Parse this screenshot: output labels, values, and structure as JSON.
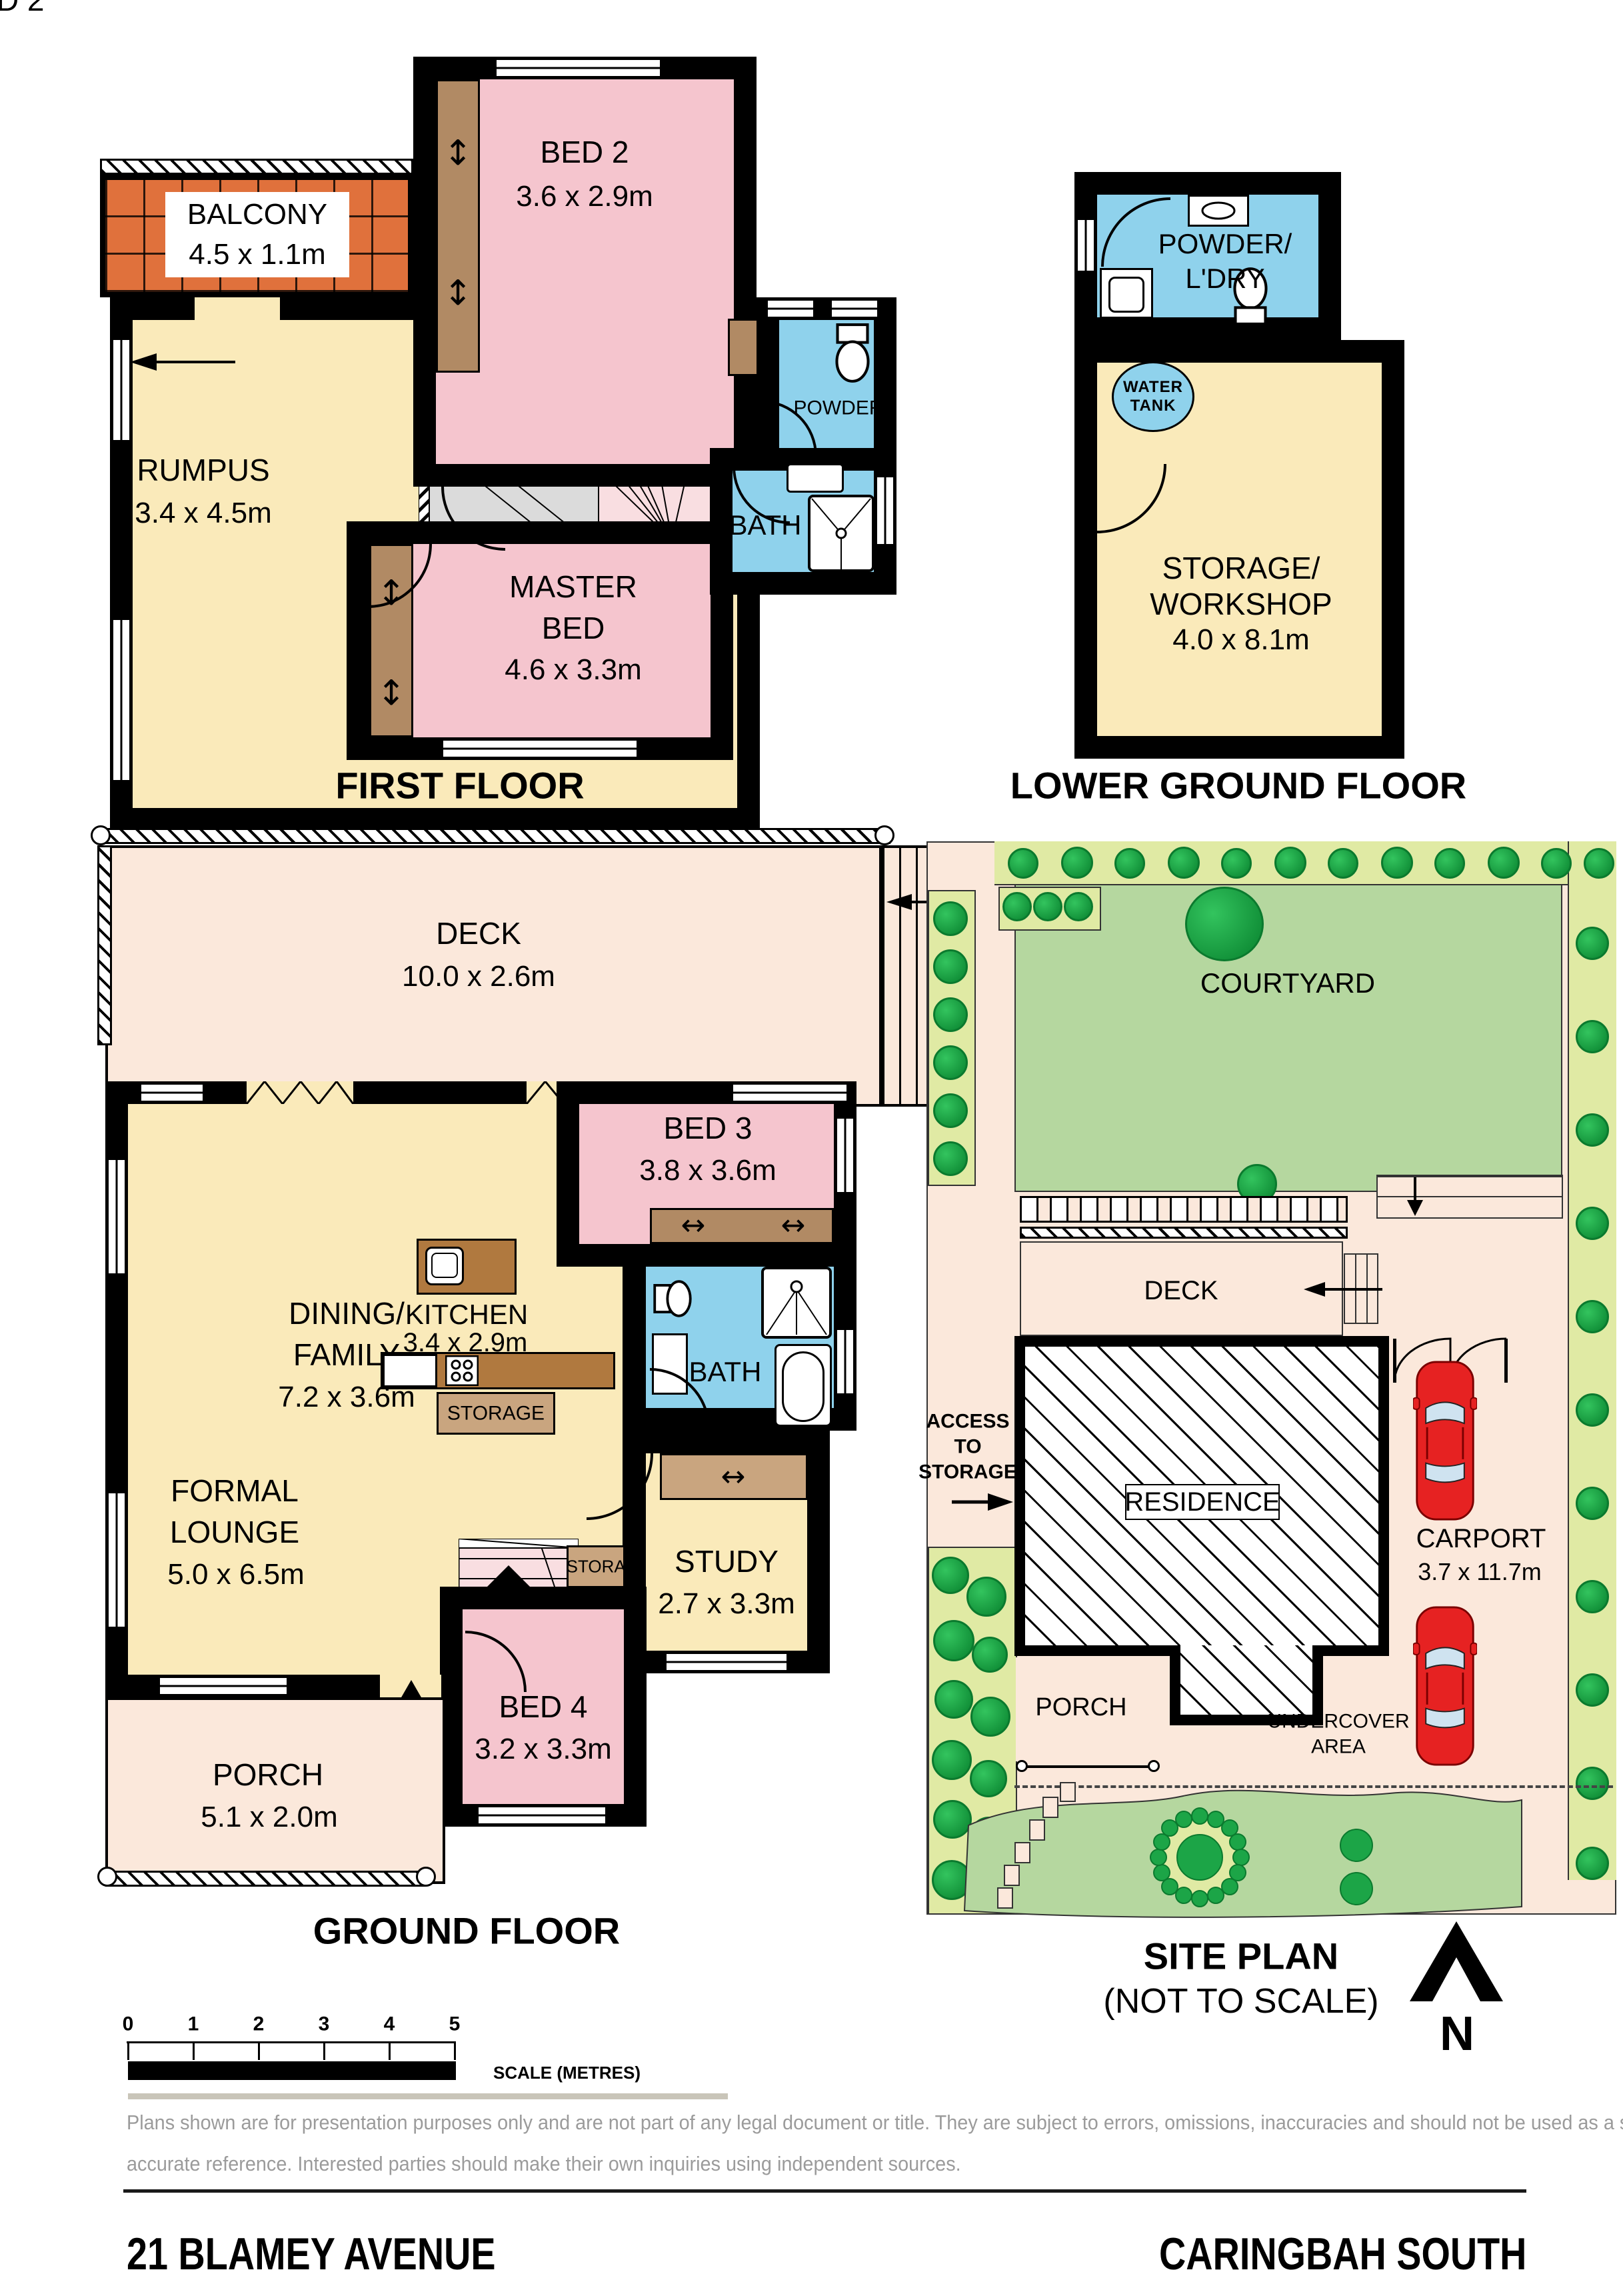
{
  "titles": {
    "first": "FIRST FLOOR",
    "lower": "LOWER GROUND FLOOR",
    "ground": "GROUND FLOOR",
    "site": "SITE PLAN",
    "site_note": "(NOT TO SCALE)"
  },
  "first_floor": {
    "bed2": {
      "name": "BED 2",
      "dims": "3.6 x 2.9m"
    },
    "balcony": {
      "name": "BALCONY",
      "dims": "4.5 x 1.1m"
    },
    "rumpus": {
      "name": "RUMPUS",
      "dims": "3.4 x 4.5m"
    },
    "master": {
      "line1": "MASTER",
      "line2": "BED",
      "dims": "4.6 x 3.3m"
    },
    "bath": {
      "name": "BATH"
    },
    "powder": {
      "name": "POWDER"
    }
  },
  "lower_ground": {
    "powder_ldry": {
      "line1": "POWDER/",
      "line2": "L'DRY"
    },
    "water_tank": {
      "line1": "WATER",
      "line2": "TANK"
    },
    "storage": {
      "line1": "STORAGE/",
      "line2": "WORKSHOP",
      "dims": "4.0 x 8.1m"
    }
  },
  "ground_floor": {
    "deck": {
      "name": "DECK",
      "dims": "10.0 x 2.6m"
    },
    "dining": {
      "line1": "DINING/",
      "line2": "FAMILY",
      "dims": "7.2 x 3.6m"
    },
    "bed3": {
      "name": "BED 3",
      "dims": "3.8 x 3.6m"
    },
    "kitchen": {
      "name": "KITCHEN",
      "dims": "3.4 x 2.9m"
    },
    "bath": {
      "name": "BATH"
    },
    "storage_kitchen": {
      "name": "STORAGE"
    },
    "storage_stairs": {
      "name": "STORAGE"
    },
    "study": {
      "name": "STUDY",
      "dims": "2.7 x 3.3m"
    },
    "bed4": {
      "name": "BED 4",
      "dims": "3.2 x 3.3m"
    },
    "porch": {
      "name": "PORCH",
      "dims": "5.1 x 2.0m"
    }
  },
  "site_plan": {
    "courtyard": "COURTYARD",
    "deck": "DECK",
    "residence": "RESIDENCE",
    "carport": {
      "name": "CARPORT",
      "dims": "3.7 x 11.7m"
    },
    "access": {
      "line1": "ACCESS",
      "line2": "TO",
      "line3": "STORAGE"
    },
    "porch": "PORCH",
    "undercover": {
      "line1": "UNDERCOVER",
      "line2": "AREA"
    },
    "north": "N"
  },
  "scale_bar": {
    "ticks": [
      "0",
      "1",
      "2",
      "3",
      "4",
      "5"
    ],
    "label": "SCALE (METRES)"
  },
  "disclaimer": {
    "line1": "Plans shown are for presentation purposes only and are not part of any legal document or title. They are subject to errors, omissions, inaccuracies and should not be used as a sole and",
    "line2": "accurate reference. Interested parties should make their own inquiries using independent sources."
  },
  "footer": {
    "address": "21 BLAMEY AVENUE",
    "suburb": "CARINGBAH SOUTH"
  },
  "colors": {
    "wall": "#000000",
    "yellow": "#FAEABA",
    "pink": "#F5C5CE",
    "blue": "#8FD2EC",
    "orange": "#E0713C",
    "peach": "#FBE8DB",
    "brown": "#B18A64",
    "tan": "#C9A57F",
    "counter": "#B0793F",
    "courtyard": "#B5D79F",
    "strip": "#E0EAA4",
    "tree": "#1CA547",
    "car": "#E62222",
    "stair_pink": "#F9DEE1"
  }
}
